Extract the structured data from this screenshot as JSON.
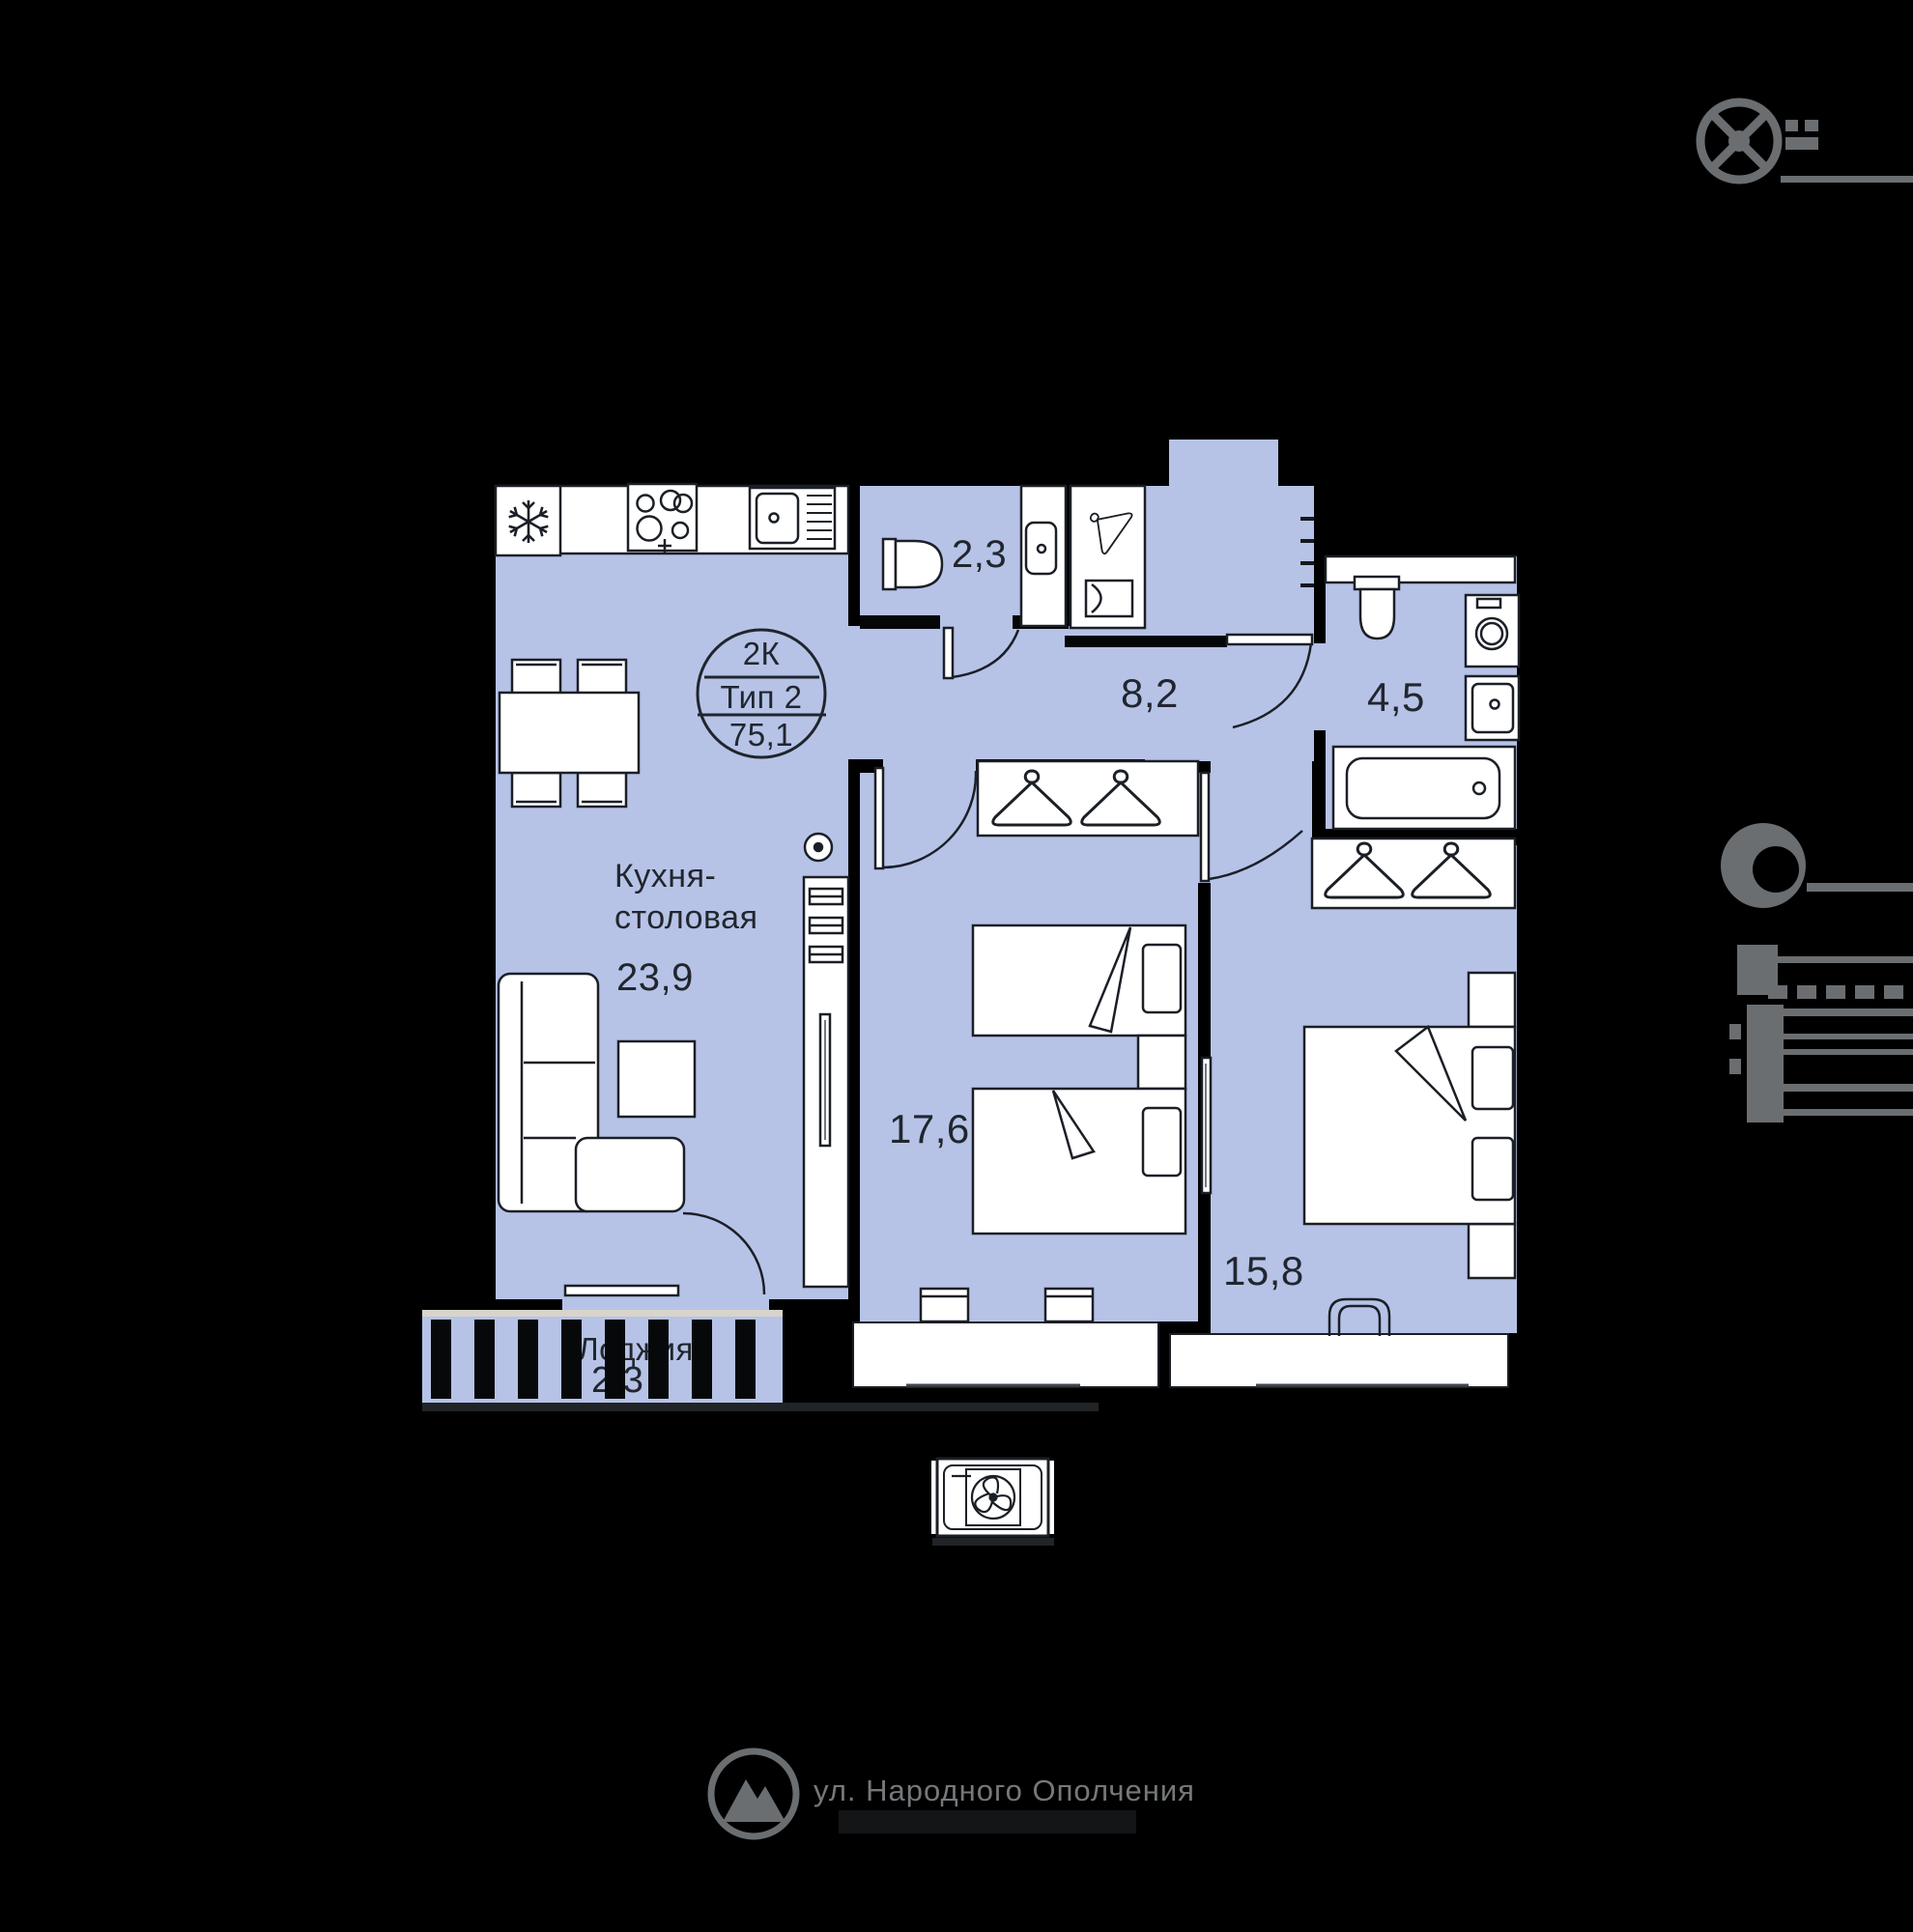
{
  "stamp": {
    "rooms_label": "2К",
    "type_label": "Тип 2",
    "total_area": "75,1"
  },
  "rooms": {
    "kitchen": {
      "name": "Кухня-столовая",
      "area": "23,9"
    },
    "wc": {
      "area": "2,3"
    },
    "hallway": {
      "area": "8,2"
    },
    "bathroom": {
      "area": "4,5"
    },
    "bedroom_twin": {
      "area": "17,6"
    },
    "bedroom_master": {
      "area": "15,8"
    },
    "loggia": {
      "name": "Лоджия",
      "area": "2,3"
    }
  },
  "footer": {
    "address": "ул. Народного Ополчения"
  },
  "colors": {
    "floor": "#b6c3e7",
    "walls": "#000000",
    "furniture_outline": "#1b1f26",
    "label_text": "#21262e",
    "site_gray": "#6b6e71"
  },
  "icons": [
    "snowflake-fridge-icon",
    "stove-burners-icon",
    "kitchen-sink-icon",
    "toilet-icon",
    "washbasin-icon",
    "hanger-icon",
    "washing-machine-icon",
    "bathtub-icon",
    "sofa-icon",
    "double-bed-icon",
    "single-bed-icon",
    "tv-icon",
    "fan-vent-icon",
    "compass-icon",
    "clock-icon",
    "logo-mountain-icon"
  ]
}
